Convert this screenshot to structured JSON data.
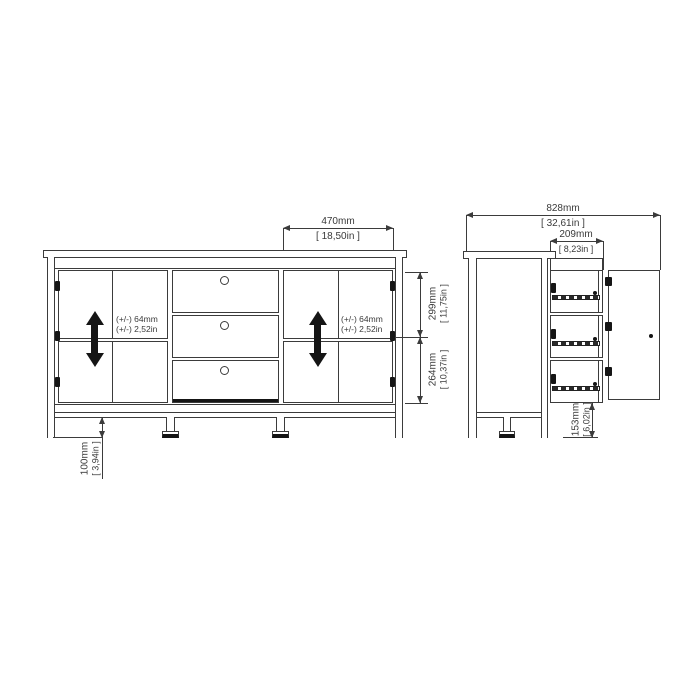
{
  "colors": {
    "line": "#3b3b3b",
    "black_fill": "#151515",
    "background": "#ffffff"
  },
  "icons": {
    "shelf_adjust": "double-headed-vertical-arrow"
  },
  "front_view": {
    "door_width": {
      "mm": "470mm",
      "in": "[ 18,50in ]"
    },
    "upper_section": {
      "mm": "299mm",
      "in": "[ 11,75in ]"
    },
    "lower_section": {
      "mm": "264mm",
      "in": "[ 10,37in ]"
    },
    "leg_height": {
      "mm": "100mm",
      "in": "[ 3,94in ]"
    },
    "shelf_adjust_left": {
      "line1": "(+/-) 64mm",
      "line2": "(+/-) 2,52in"
    },
    "shelf_adjust_right": {
      "line1": "(+/-) 64mm",
      "line2": "(+/-) 2,52in"
    }
  },
  "side_view": {
    "open_depth": {
      "mm": "828mm",
      "in": "[ 32,61in ]"
    },
    "drawer_extension": {
      "mm": "209mm",
      "in": "[ 8,23in ]"
    },
    "bottom_height": {
      "mm": "153mm",
      "in": "[ 6,02in ]"
    }
  }
}
